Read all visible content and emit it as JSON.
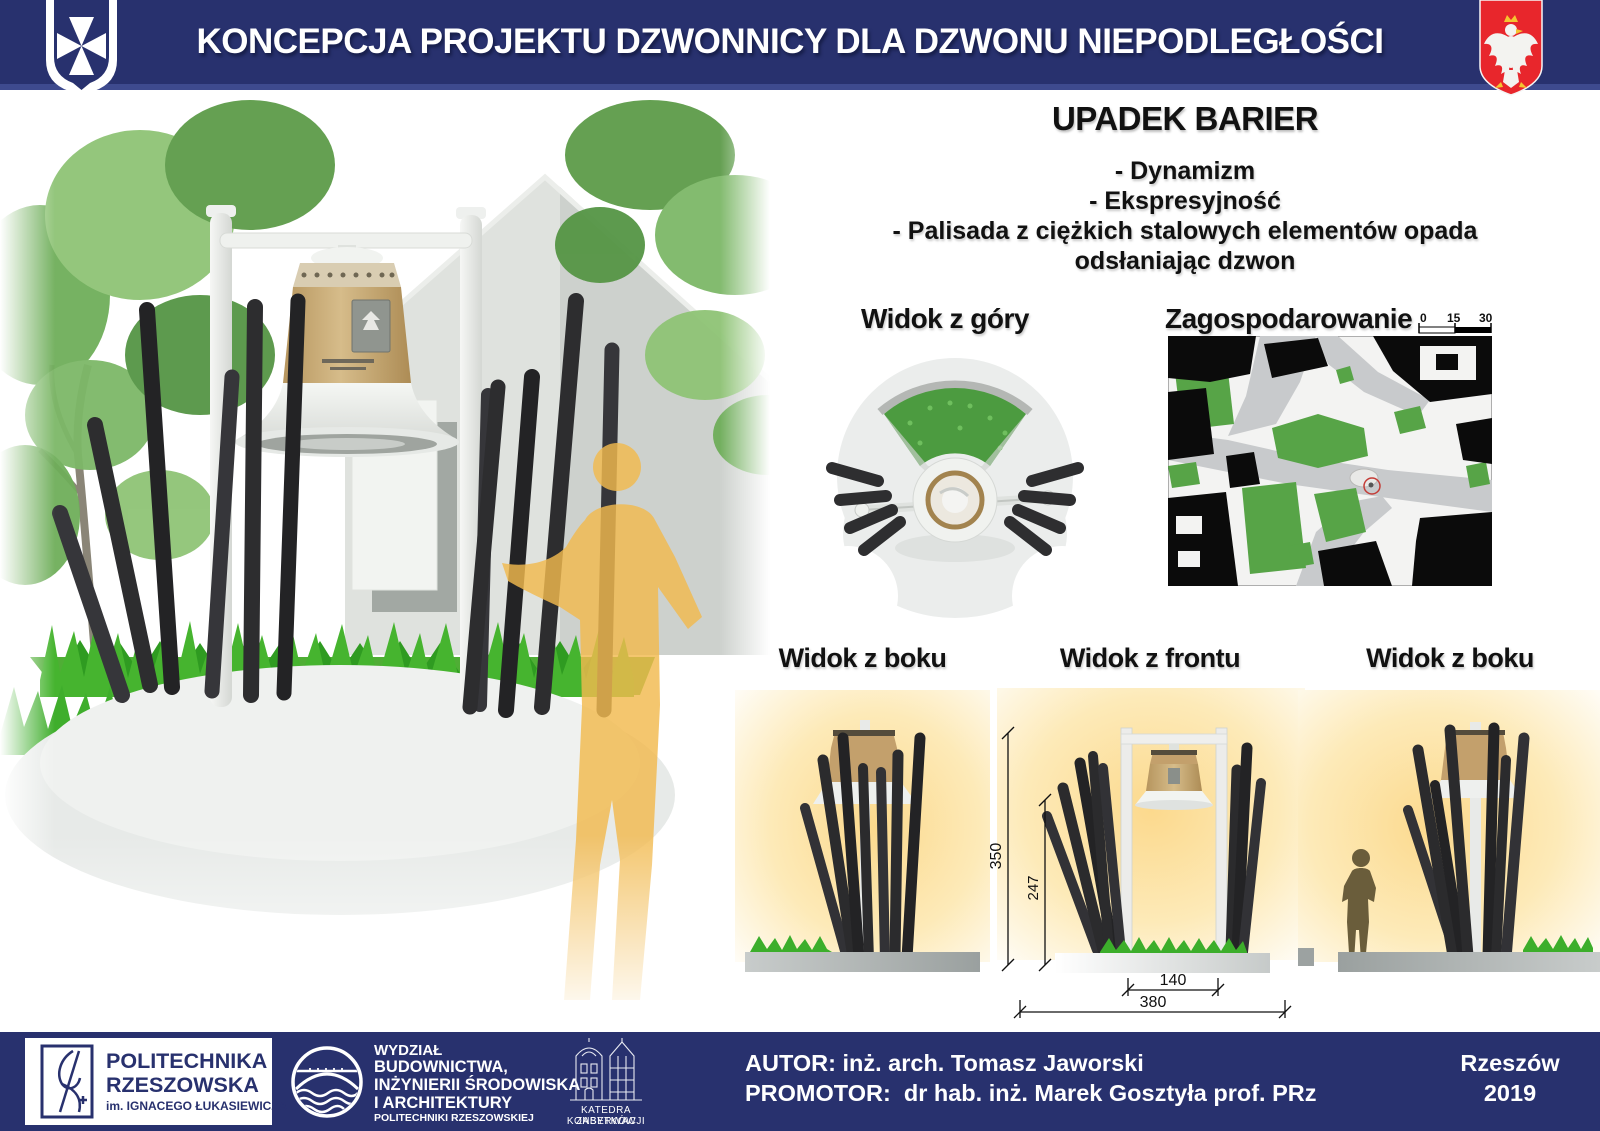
{
  "header": {
    "title": "KONCEPCJA PROJEKTU DZWONNICY DLA DZWONU NIEPODLEGŁOŚCI",
    "left_emblem": "rzeszow-coat-of-arms",
    "right_emblem": "polish-eagle-emblem"
  },
  "concept": {
    "title": "UPADEK BARIER",
    "bullets": [
      "- Dynamizm",
      "- Ekspresyjność",
      "- Palisada z ciężkich stalowych elementów opada odsłaniając dzwon"
    ]
  },
  "views": {
    "top_view": {
      "label": "Widok z góry"
    },
    "site_plan": {
      "label": "Zagospodarowanie",
      "scale_ticks": [
        "0",
        "15",
        "30"
      ]
    },
    "side_left": {
      "label": "Widok z boku"
    },
    "front": {
      "label": "Widok z frontu"
    },
    "side_right": {
      "label": "Widok z boku"
    }
  },
  "dimensions": {
    "total_height": "350",
    "bell_height": "247",
    "frame_width": "140",
    "base_width": "380"
  },
  "footer": {
    "university": {
      "line1": "POLITECHNIKA",
      "line2": "RZESZOWSKA",
      "line3": "im. IGNACEGO ŁUKASIEWICZA"
    },
    "faculty": {
      "line1": "WYDZIAŁ",
      "line2": "BUDOWNICTWA,",
      "line3": "INŻYNIERII ŚRODOWISKA",
      "line4": "I ARCHITEKTURY",
      "line5": "POLITECHNIKI RZESZOWSKIEJ"
    },
    "department": {
      "line1": "KATEDRA KONSERWACJI",
      "line2": "ZABYTKÓW"
    },
    "author_line": "AUTOR: inż. arch. Tomasz Jaworski",
    "promotor_line": "PROMOTOR:  dr hab. inż. Marek Gosztyła prof. PRz",
    "city": "Rzeszów",
    "year": "2019"
  },
  "colors": {
    "navy": "#28316E",
    "emblem_red": "#E8262C",
    "bell_tan": "#C5A06A",
    "pole_dark": "#2D2D2F",
    "grass_green": "#45B52E",
    "map_green": "#57A447"
  }
}
